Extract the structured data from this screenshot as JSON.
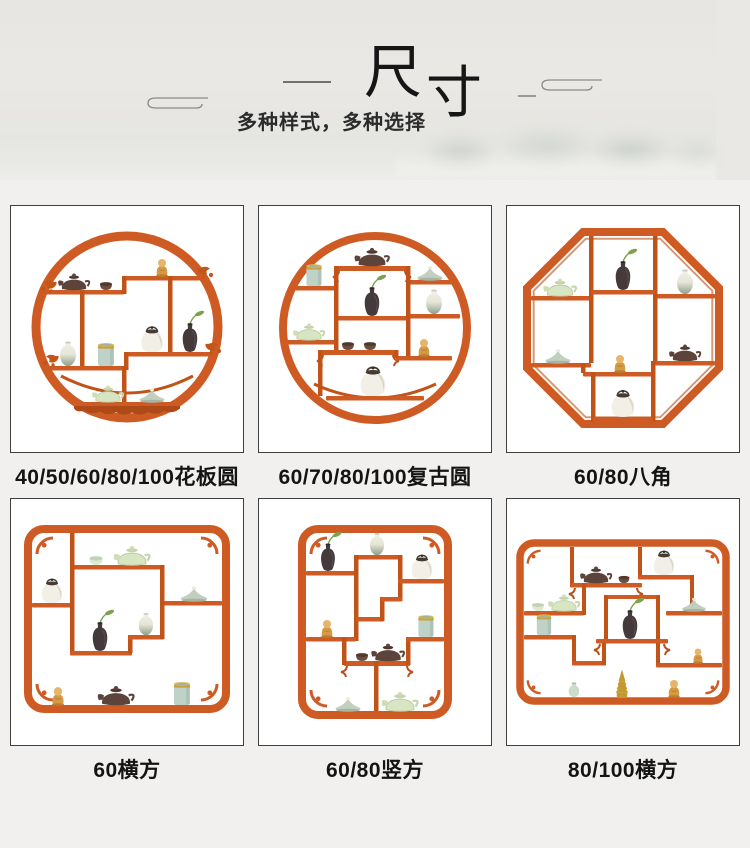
{
  "header": {
    "title": "尺寸",
    "title_char1": "尺",
    "title_char2": "寸",
    "subtitle": "多种样式，多种选择",
    "decor_left": "auspicious-cloud",
    "decor_right": "auspicious-cloud"
  },
  "products": [
    {
      "label": "40/50/60/80/100花板圆",
      "shape": "carved-panel-circle"
    },
    {
      "label": "60/70/80/100复古圆",
      "shape": "vintage-circle"
    },
    {
      "label": "60/80八角",
      "shape": "octagon"
    },
    {
      "label": "60横方",
      "shape": "horizontal-square"
    },
    {
      "label": "60/80竖方",
      "shape": "vertical-square"
    },
    {
      "label": "80/100横方",
      "shape": "horizontal-rectangle"
    }
  ],
  "colors": {
    "wood": "#cf5b24",
    "wood_dark": "#c05318",
    "page_bg": "#f1f0ee",
    "card_bg": "#ffffff",
    "card_border": "#3f3f3f",
    "title_color": "#161616"
  }
}
